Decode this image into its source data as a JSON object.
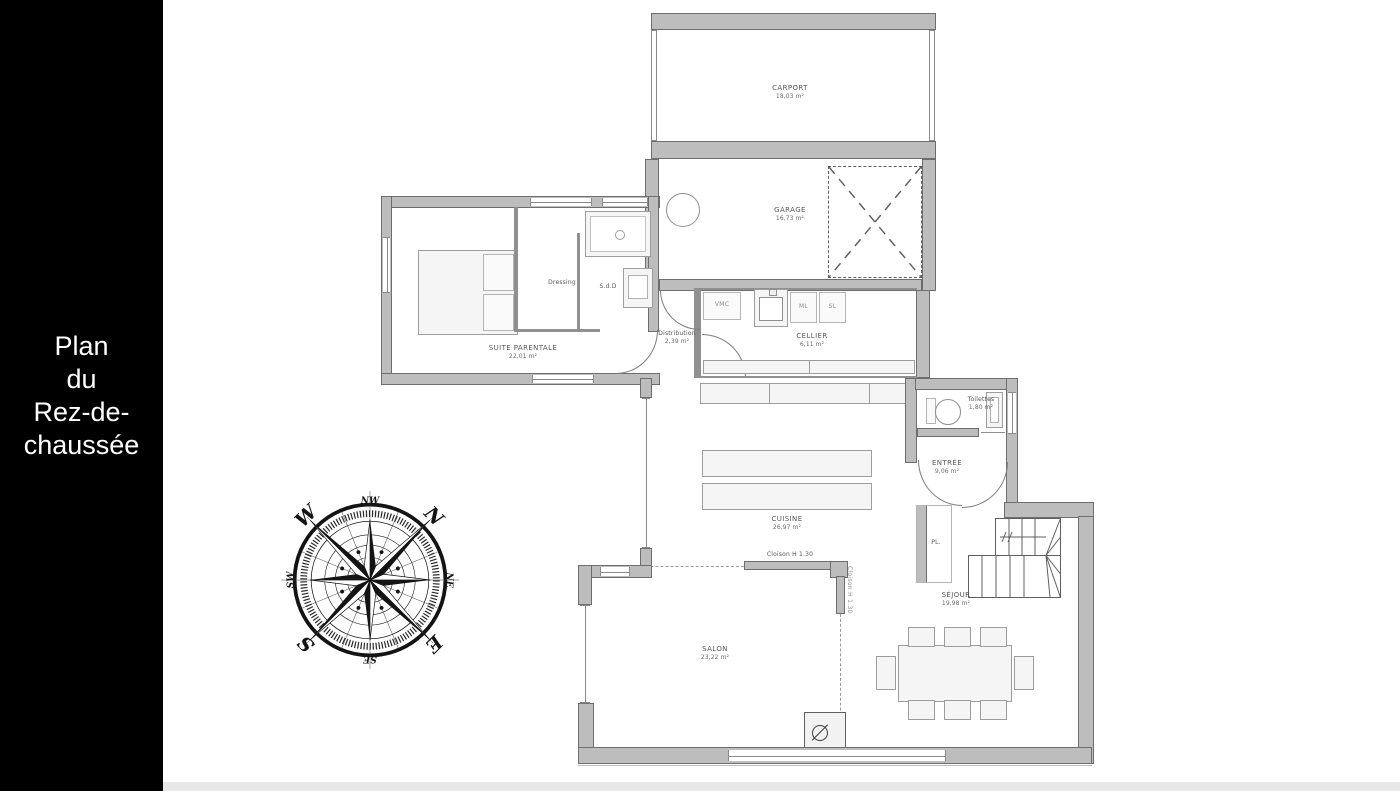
{
  "sidebar": {
    "line1": "Plan",
    "line2": "du",
    "line3": "Rez-de-",
    "line4": "chaussée"
  },
  "rooms": {
    "carport": {
      "name": "CARPORT",
      "area": "18,03 m²"
    },
    "garage": {
      "name": "GARAGE",
      "area": "16,73 m²"
    },
    "cellier": {
      "name": "CELLIER",
      "area": "6,11 m²"
    },
    "suite": {
      "name": "SUITE PARENTALE",
      "area": "22,01 m²"
    },
    "dressing": {
      "name": "Dressing"
    },
    "sdd": {
      "name": "S.d.D"
    },
    "distribution": {
      "name": "Distribution",
      "area": "2,39 m²"
    },
    "cuisine": {
      "name": "CUISINE",
      "area": "26,97 m²"
    },
    "toilettes": {
      "name": "Toilettes",
      "area": "1,80 m²"
    },
    "entree": {
      "name": "ENTRÉE",
      "area": "9,06 m²"
    },
    "pl": {
      "name": "PL."
    },
    "sejour": {
      "name": "SÉJOUR",
      "area": "19,98 m²"
    },
    "salon": {
      "name": "SALON",
      "area": "23,22 m²"
    }
  },
  "appliances": {
    "vmc": "VMC",
    "ml": "ML",
    "sl": "SL"
  },
  "annotations": {
    "cloison": "Cloison H 1.30"
  },
  "compass": {
    "n": "N",
    "ne": "NE",
    "e": "E",
    "se": "SE",
    "s": "S",
    "sw": "SW",
    "w": "W",
    "nw": "NW"
  },
  "colors": {
    "wall": "#bdbdbd",
    "wall_edge": "#6e6e6e",
    "panel": "#000000",
    "furniture": "#f5f5f5"
  }
}
